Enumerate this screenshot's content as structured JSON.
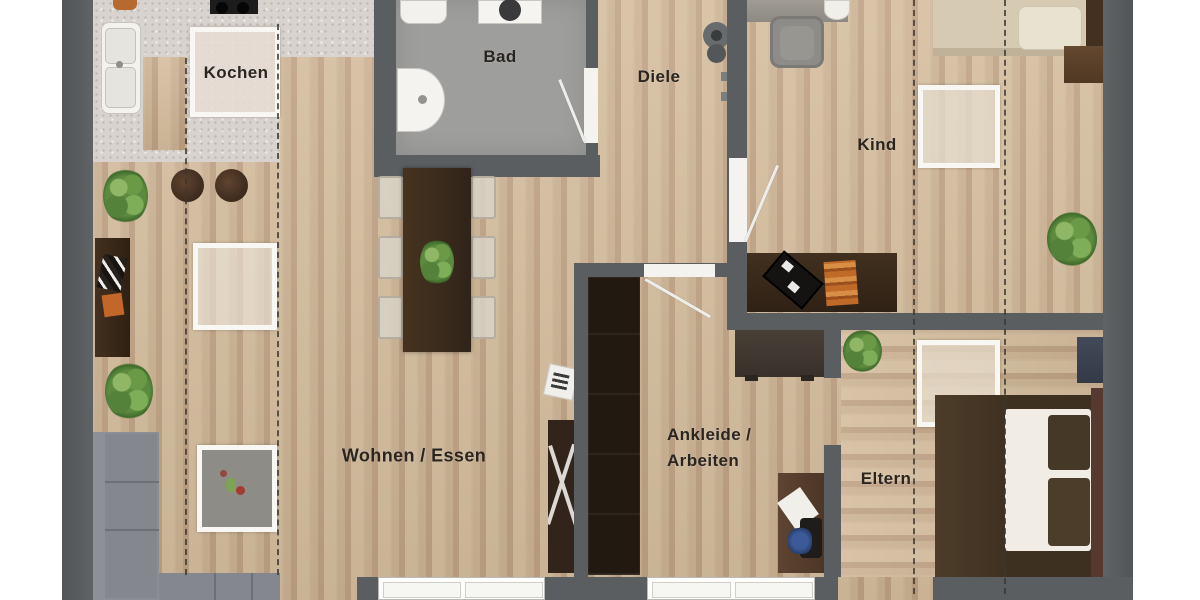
{
  "title": "Apartment floor plan (Grundriss)",
  "labels": {
    "kochen": "Kochen",
    "bad": "Bad",
    "diele": "Diele",
    "kind": "Kind",
    "wohnen_essen": "Wohnen / Essen",
    "ankleide_line1": "Ankleide /",
    "ankleide_line2": "Arbeiten",
    "eltern": "Eltern"
  },
  "colors": {
    "bg": "#ffffff",
    "wall": "#5a5e61",
    "floor": "#c9b193",
    "floor-seam": "#bca084",
    "floor-light": "#d3bd9f",
    "bath": "#9e9e9c",
    "counter": "#d8d3ce",
    "dark-furn": "#362818",
    "wardrobe": "#221911",
    "sofa": "#84878d",
    "sofa-seam": "#6d7077",
    "mattress": "#f1ede4",
    "kind-bed": "#d6cab2",
    "rug-fill": "#e8e1d4",
    "label": "#2b2520",
    "plant": "#5c8a3e",
    "accent-orange": "#bd6c2a",
    "tv-black": "#141311",
    "window": "#fdfdfb"
  }
}
